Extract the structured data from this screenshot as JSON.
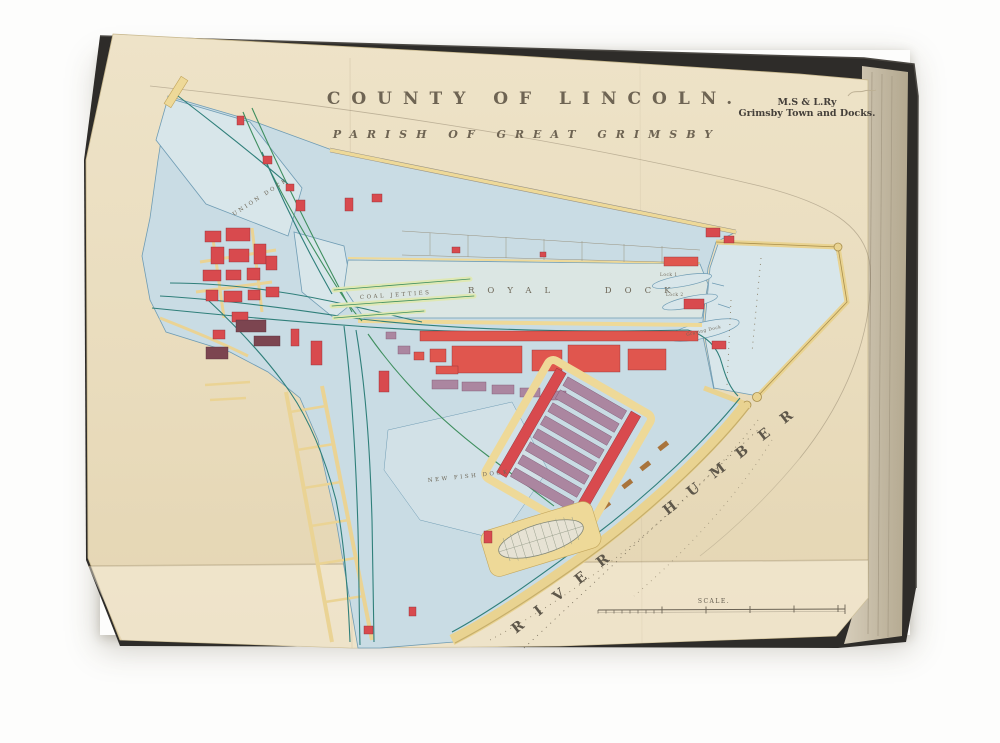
{
  "map": {
    "title": "COUNTY OF LINCOLN.",
    "subtitle": "PARISH OF GREAT GRIMSBY",
    "corner_caption": {
      "line1": "M.S & L.Ry",
      "line2": "Grimsby Town and Docks."
    },
    "labels": {
      "royal_dock": "ROYAL DOCK",
      "union_dock": "UNION DOCK",
      "coal_jetties": "COAL JETTIES",
      "new_fish_dock": "NEW FISH DOCK",
      "river_humber": "RIVER HUMBER",
      "lock_1": "Lock 1",
      "lock_2": "Lock 2",
      "graving_dock": "Graving Dock",
      "scale": "SCALE."
    },
    "colors": {
      "paper": "#ebdfc2",
      "land_tint": "#c9dce4",
      "water": "#d8e6ea",
      "quay_yellow": "#eed998",
      "building_red": "#d84a4e",
      "warehouse_purple": "#ab86a0",
      "railway_teal": "#2f7f7a",
      "railway_green": "#3f8f5f",
      "ink": "#6e6758",
      "book_cover": "#2e2c29"
    }
  }
}
